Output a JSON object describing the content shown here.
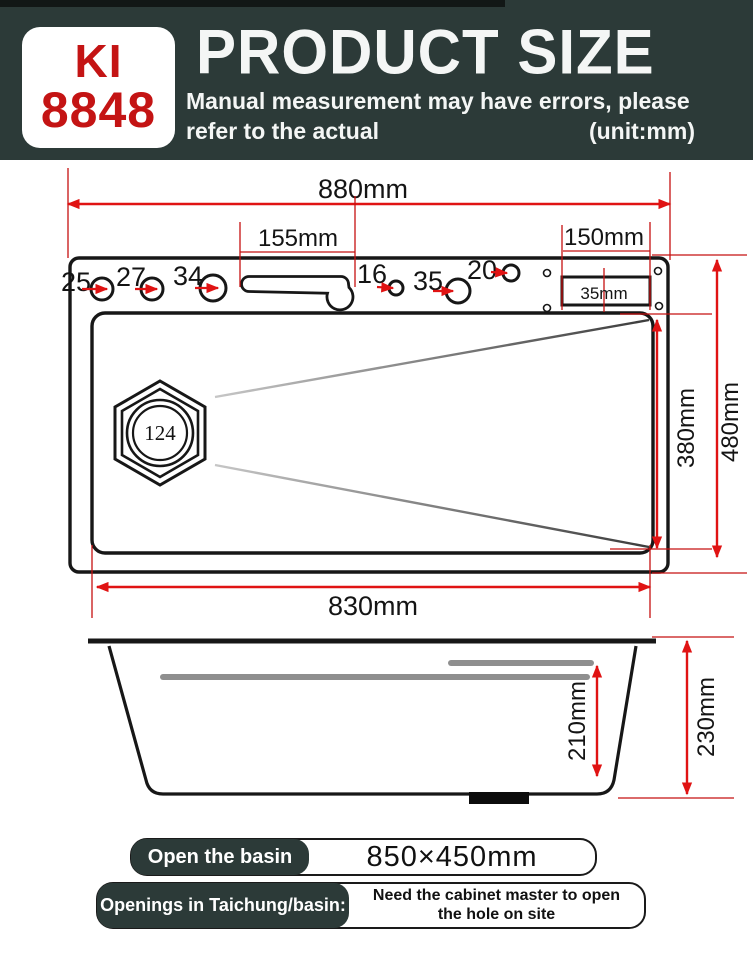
{
  "header": {
    "model_top": "KI",
    "model_bottom": "8848",
    "title": "PRODUCT SIZE",
    "subtitle_line1": "Manual measurement may have errors, please",
    "subtitle_line2": "refer to the actual",
    "unit_note": "(unit:mm)"
  },
  "colors": {
    "header_bg": "#2c3a38",
    "dimension_red": "#e01313",
    "brand_red": "#c41414",
    "rail_grey": "#8f8f8f"
  },
  "top_view": {
    "overall_width": "880mm",
    "faucet_slot_width": "155mm",
    "cutout_width": "150mm",
    "cutout_depth": "35mm",
    "basin_length": "830mm",
    "basin_depth": "380mm",
    "overall_depth": "480mm",
    "drain_label": "124",
    "holes": [
      {
        "label": "25"
      },
      {
        "label": "27"
      },
      {
        "label": "34"
      },
      {
        "label": "16"
      },
      {
        "label": "35"
      },
      {
        "label": "20"
      }
    ]
  },
  "side_view": {
    "inner_depth": "210mm",
    "overall_height": "230mm"
  },
  "footer": {
    "basin_label": "Open the basin",
    "basin_size": "850×450mm",
    "openings_label": "Openings in Taichung/basin:",
    "openings_note_line1": "Need the cabinet master to open",
    "openings_note_line2": "the hole on site"
  }
}
